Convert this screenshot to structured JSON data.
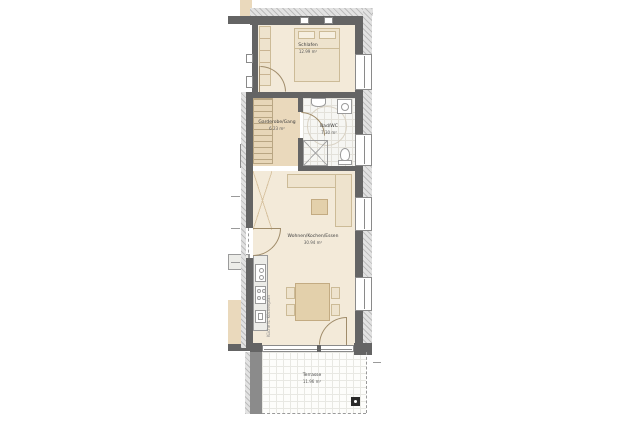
{
  "plan": {
    "title": "apartment-floor-plan",
    "rooms": [
      {
        "id": "schlafen",
        "name": "Schlafen",
        "area": "12.99 m²"
      },
      {
        "id": "garderobe",
        "name": "Garderobe/Gang",
        "area": "6.23 m²"
      },
      {
        "id": "bad",
        "name": "Bad/WC",
        "area": "7.30 m²"
      },
      {
        "id": "wohnen",
        "name": "Wohnen/Kochen/Essen",
        "area": "30.94 m²"
      },
      {
        "id": "terrasse",
        "name": "Terrasse",
        "area": "11.96 m²"
      }
    ],
    "annotations": {
      "kitchen_note": "Küche lt. Küchenplan"
    },
    "icons": {
      "drain": "terrace-drain-icon"
    },
    "colors": {
      "wall": "#646464",
      "wall_outer_hatch": "#bdbdbd",
      "floor_unit": "#f3ead9",
      "floor_corridor": "#ead9bc",
      "floor_bath": "#f6f6f3",
      "floor_terrace": "#fdfdfb",
      "furniture": "#eee3cd",
      "furniture_dark": "#e3d0ab",
      "background": "#ffffff"
    }
  }
}
